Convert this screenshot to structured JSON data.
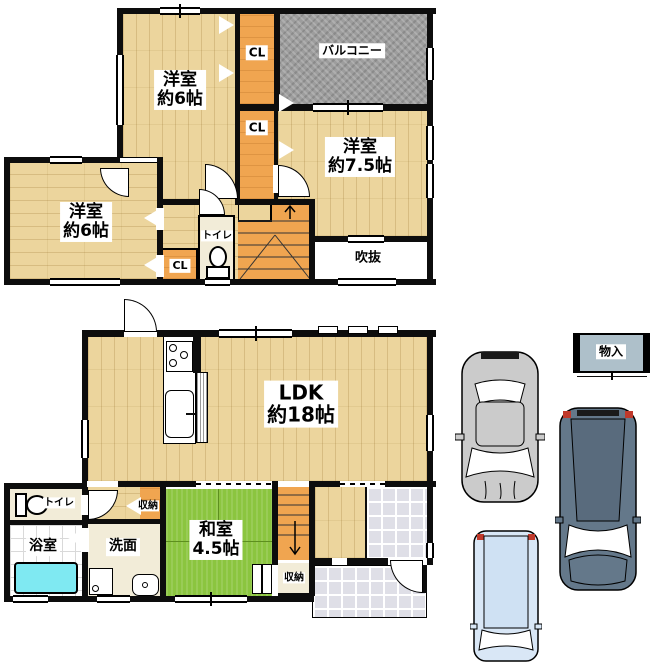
{
  "floor2": {
    "room_west_top": {
      "name": "洋室",
      "size": "約6帖"
    },
    "closet_top": "CL",
    "balcony": "バルコニー",
    "closet_mid": "CL",
    "room_west_right": {
      "name": "洋室",
      "size": "約7.5帖"
    },
    "room_west_left": {
      "name": "洋室",
      "size": "約6帖"
    },
    "closet_left": "CL",
    "toilet": "トイレ",
    "void": "吹抜"
  },
  "floor1": {
    "ldk": {
      "name": "LDK",
      "size": "約18帖"
    },
    "washitsu": {
      "name": "和室",
      "size": "4.5帖"
    },
    "toilet": "トイレ",
    "bath": "浴室",
    "washroom": "洗面",
    "hall_storage": "収納",
    "washitsu_storage": "収納"
  },
  "exterior": {
    "storage_box": "物入"
  },
  "colors": {
    "wood": "#ecd59d",
    "closet_orange": "#f0a550",
    "tatami_green": "#8bc53f",
    "balcony_grey": "#9d9d9d",
    "bathtub_cyan": "#7fe9f2",
    "car_grey": "#cbcbcb",
    "car_dark": "#64788a",
    "car_light": "#d9e7f6"
  }
}
